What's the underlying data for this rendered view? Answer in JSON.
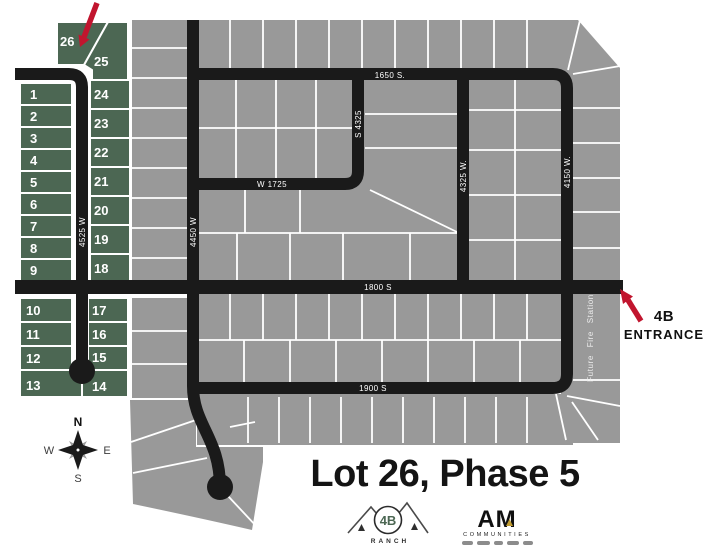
{
  "title": "Lot 26, Phase 5",
  "entrance_label": {
    "line1": "4B",
    "line2": "ENTRANCE"
  },
  "streets": {
    "s1650": "1650 S.",
    "w1725": "W 1725",
    "s1800": "1800 S",
    "s1900": "1900 S",
    "w4525": "4525 W",
    "w4450": "4450 W",
    "s4325": "S 4325",
    "w4325": "4325 W.",
    "w4150": "4150 W."
  },
  "labels": {
    "future_fire_station": "Future Fire Station"
  },
  "compass": {
    "n": "N",
    "e": "E",
    "s": "S",
    "w": "W"
  },
  "lots": [
    "1",
    "2",
    "3",
    "4",
    "5",
    "6",
    "7",
    "8",
    "9",
    "10",
    "11",
    "12",
    "13",
    "14",
    "15",
    "16",
    "17",
    "18",
    "19",
    "20",
    "21",
    "22",
    "23",
    "24",
    "25",
    "26"
  ],
  "logos": {
    "ranch_name": "4B",
    "ranch_sub": "RANCH",
    "am_name": "AM",
    "am_sub": "COMMUNITIES"
  },
  "colors": {
    "lot_green": "#4c6753",
    "lot_gray": "#999999",
    "road_black": "#1a1a1a",
    "arrow_red": "#c1152e",
    "divider_white": "#ffffff"
  }
}
